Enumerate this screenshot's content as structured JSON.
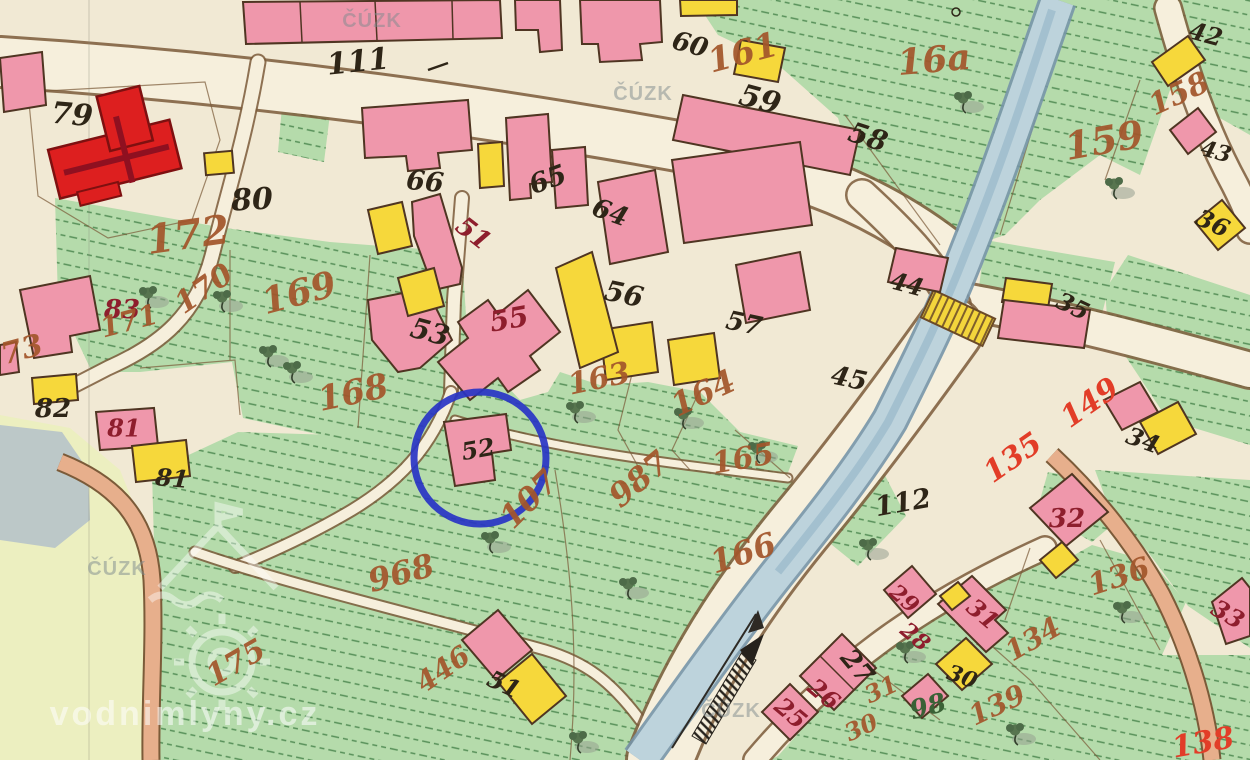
{
  "map": {
    "description": "Historical cadastral map sheet with highlighted building parcel 52",
    "highlight": {
      "shape": "circle",
      "target_parcel": "52",
      "color": "#2834c4"
    },
    "watermark_agency": "ČÚZK",
    "watermark_site": "vodnimlyny.cz",
    "labels": [
      {
        "t": "111",
        "x": 358,
        "y": 62,
        "r": -6,
        "s": 30,
        "c": "ink"
      },
      {
        "t": "79",
        "x": 72,
        "y": 115,
        "r": 5,
        "s": 30,
        "c": "ink"
      },
      {
        "t": "80",
        "x": 252,
        "y": 200,
        "r": -3,
        "s": 30,
        "c": "ink"
      },
      {
        "t": "66",
        "x": 425,
        "y": 182,
        "r": 5,
        "s": 27,
        "c": "ink"
      },
      {
        "t": "65",
        "x": 548,
        "y": 180,
        "r": -20,
        "s": 27,
        "c": "ink"
      },
      {
        "t": "60",
        "x": 690,
        "y": 45,
        "r": 15,
        "s": 26,
        "c": "ink"
      },
      {
        "t": "59",
        "x": 760,
        "y": 100,
        "r": 15,
        "s": 30,
        "c": "ink"
      },
      {
        "t": "58",
        "x": 868,
        "y": 137,
        "r": 18,
        "s": 28,
        "c": "ink"
      },
      {
        "t": "42",
        "x": 1206,
        "y": 34,
        "r": 15,
        "s": 24,
        "c": "ink"
      },
      {
        "t": "43",
        "x": 1216,
        "y": 152,
        "r": 15,
        "s": 22,
        "c": "ink"
      },
      {
        "t": "36",
        "x": 1213,
        "y": 223,
        "r": 25,
        "s": 24,
        "c": "ink"
      },
      {
        "t": "64",
        "x": 610,
        "y": 213,
        "r": 20,
        "s": 26,
        "c": "ink"
      },
      {
        "t": "53",
        "x": 430,
        "y": 332,
        "r": 15,
        "s": 28,
        "c": "ink"
      },
      {
        "t": "56",
        "x": 624,
        "y": 294,
        "r": 12,
        "s": 28,
        "c": "ink"
      },
      {
        "t": "57",
        "x": 744,
        "y": 324,
        "r": 12,
        "s": 26,
        "c": "ink"
      },
      {
        "t": "45",
        "x": 849,
        "y": 379,
        "r": 12,
        "s": 26,
        "c": "ink"
      },
      {
        "t": "44",
        "x": 907,
        "y": 284,
        "r": 15,
        "s": 24,
        "c": "ink"
      },
      {
        "t": "35",
        "x": 1073,
        "y": 306,
        "r": 25,
        "s": 24,
        "c": "ink"
      },
      {
        "t": "34",
        "x": 1143,
        "y": 440,
        "r": 20,
        "s": 24,
        "c": "ink"
      },
      {
        "t": "82",
        "x": 53,
        "y": 409,
        "r": 0,
        "s": 26,
        "c": "ink"
      },
      {
        "t": "81",
        "x": 172,
        "y": 478,
        "r": 5,
        "s": 24,
        "c": "ink"
      },
      {
        "t": "112",
        "x": 903,
        "y": 503,
        "r": -10,
        "s": 27,
        "c": "ink"
      },
      {
        "t": "27",
        "x": 857,
        "y": 667,
        "r": 50,
        "s": 26,
        "c": "ink"
      },
      {
        "t": "30",
        "x": 962,
        "y": 677,
        "r": 20,
        "s": 22,
        "c": "ink"
      },
      {
        "t": "52",
        "x": 478,
        "y": 449,
        "r": -10,
        "s": 24,
        "c": "ink"
      },
      {
        "t": "51",
        "x": 504,
        "y": 684,
        "r": 25,
        "s": 24,
        "c": "ink"
      },
      {
        "t": "98",
        "x": 928,
        "y": 707,
        "r": -15,
        "s": 26,
        "c": "green"
      },
      {
        "t": "83",
        "x": 122,
        "y": 310,
        "r": 0,
        "s": 26,
        "c": "carmine"
      },
      {
        "t": "81",
        "x": 124,
        "y": 428,
        "r": 0,
        "s": 24,
        "c": "carmine"
      },
      {
        "t": "51",
        "x": 473,
        "y": 234,
        "r": 38,
        "s": 26,
        "c": "carmine"
      },
      {
        "t": "55",
        "x": 509,
        "y": 319,
        "r": -10,
        "s": 28,
        "c": "carmine"
      },
      {
        "t": "25",
        "x": 791,
        "y": 713,
        "r": 40,
        "s": 24,
        "c": "carmine"
      },
      {
        "t": "26",
        "x": 824,
        "y": 694,
        "r": 40,
        "s": 24,
        "c": "carmine"
      },
      {
        "t": "28",
        "x": 915,
        "y": 637,
        "r": 40,
        "s": 22,
        "c": "carmine"
      },
      {
        "t": "29",
        "x": 904,
        "y": 599,
        "r": 40,
        "s": 22,
        "c": "carmine"
      },
      {
        "t": "31",
        "x": 983,
        "y": 614,
        "r": 40,
        "s": 24,
        "c": "carmine"
      },
      {
        "t": "32",
        "x": 1067,
        "y": 519,
        "r": 0,
        "s": 26,
        "c": "carmine"
      },
      {
        "t": "33",
        "x": 1228,
        "y": 614,
        "r": 30,
        "s": 24,
        "c": "carmine"
      },
      {
        "t": "172",
        "x": 188,
        "y": 235,
        "r": -8,
        "s": 40,
        "c": "sepia"
      },
      {
        "t": "161",
        "x": 743,
        "y": 53,
        "r": -15,
        "s": 34,
        "c": "sepia"
      },
      {
        "t": "16a",
        "x": 934,
        "y": 60,
        "r": -5,
        "s": 36,
        "c": "sepia"
      },
      {
        "t": "158",
        "x": 1179,
        "y": 94,
        "r": -25,
        "s": 30,
        "c": "sepia"
      },
      {
        "t": "159",
        "x": 1104,
        "y": 140,
        "r": -10,
        "s": 38,
        "c": "sepia"
      },
      {
        "t": "169",
        "x": 299,
        "y": 293,
        "r": -15,
        "s": 36,
        "c": "sepia"
      },
      {
        "t": "170",
        "x": 204,
        "y": 289,
        "r": -35,
        "s": 30,
        "c": "sepia"
      },
      {
        "t": "171",
        "x": 129,
        "y": 321,
        "r": -15,
        "s": 28,
        "c": "sepia"
      },
      {
        "t": "73",
        "x": 22,
        "y": 350,
        "r": -15,
        "s": 30,
        "c": "sepia"
      },
      {
        "t": "168",
        "x": 353,
        "y": 393,
        "r": -12,
        "s": 34,
        "c": "sepia"
      },
      {
        "t": "163",
        "x": 599,
        "y": 379,
        "r": -12,
        "s": 30,
        "c": "sepia"
      },
      {
        "t": "164",
        "x": 703,
        "y": 393,
        "r": -25,
        "s": 32,
        "c": "sepia"
      },
      {
        "t": "165",
        "x": 743,
        "y": 459,
        "r": -10,
        "s": 30,
        "c": "sepia"
      },
      {
        "t": "107",
        "x": 529,
        "y": 499,
        "r": -45,
        "s": 32,
        "c": "sepia"
      },
      {
        "t": "987",
        "x": 639,
        "y": 479,
        "r": -40,
        "s": 32,
        "c": "sepia"
      },
      {
        "t": "166",
        "x": 743,
        "y": 553,
        "r": -18,
        "s": 32,
        "c": "sepia"
      },
      {
        "t": "968",
        "x": 401,
        "y": 573,
        "r": -15,
        "s": 32,
        "c": "sepia"
      },
      {
        "t": "175",
        "x": 236,
        "y": 663,
        "r": -30,
        "s": 30,
        "c": "sepia"
      },
      {
        "t": "446",
        "x": 443,
        "y": 669,
        "r": -35,
        "s": 28,
        "c": "sepia"
      },
      {
        "t": "136",
        "x": 1119,
        "y": 577,
        "r": -18,
        "s": 30,
        "c": "sepia"
      },
      {
        "t": "134",
        "x": 1033,
        "y": 639,
        "r": -30,
        "s": 28,
        "c": "sepia"
      },
      {
        "t": "139",
        "x": 997,
        "y": 705,
        "r": -25,
        "s": 28,
        "c": "sepia"
      },
      {
        "t": "31",
        "x": 881,
        "y": 689,
        "r": -25,
        "s": 24,
        "c": "sepia"
      },
      {
        "t": "30",
        "x": 861,
        "y": 727,
        "r": -25,
        "s": 24,
        "c": "sepia"
      },
      {
        "t": "135",
        "x": 1013,
        "y": 458,
        "r": -35,
        "s": 30,
        "c": "red"
      },
      {
        "t": "149",
        "x": 1090,
        "y": 403,
        "r": -35,
        "s": 30,
        "c": "red"
      },
      {
        "t": "138",
        "x": 1203,
        "y": 743,
        "r": -10,
        "s": 30,
        "c": "red"
      },
      {
        "t": "ČÚZK",
        "x": 372,
        "y": 21,
        "r": 0,
        "s": 20,
        "c": "wm",
        "n": "watermark-cuzk"
      },
      {
        "t": "ČÚZK",
        "x": 643,
        "y": 94,
        "r": 0,
        "s": 20,
        "c": "wm",
        "n": "watermark-cuzk"
      },
      {
        "t": "ČÚZK",
        "x": 117,
        "y": 569,
        "r": 0,
        "s": 20,
        "c": "wm",
        "n": "watermark-cuzk"
      },
      {
        "t": "ČÚZK",
        "x": 731,
        "y": 711,
        "r": 0,
        "s": 20,
        "c": "wm",
        "n": "watermark-cuzk"
      },
      {
        "t": "vodnimlyny.cz",
        "x": 185,
        "y": 714,
        "r": 0,
        "s": 34,
        "c": "site",
        "n": "watermark-site"
      }
    ]
  }
}
